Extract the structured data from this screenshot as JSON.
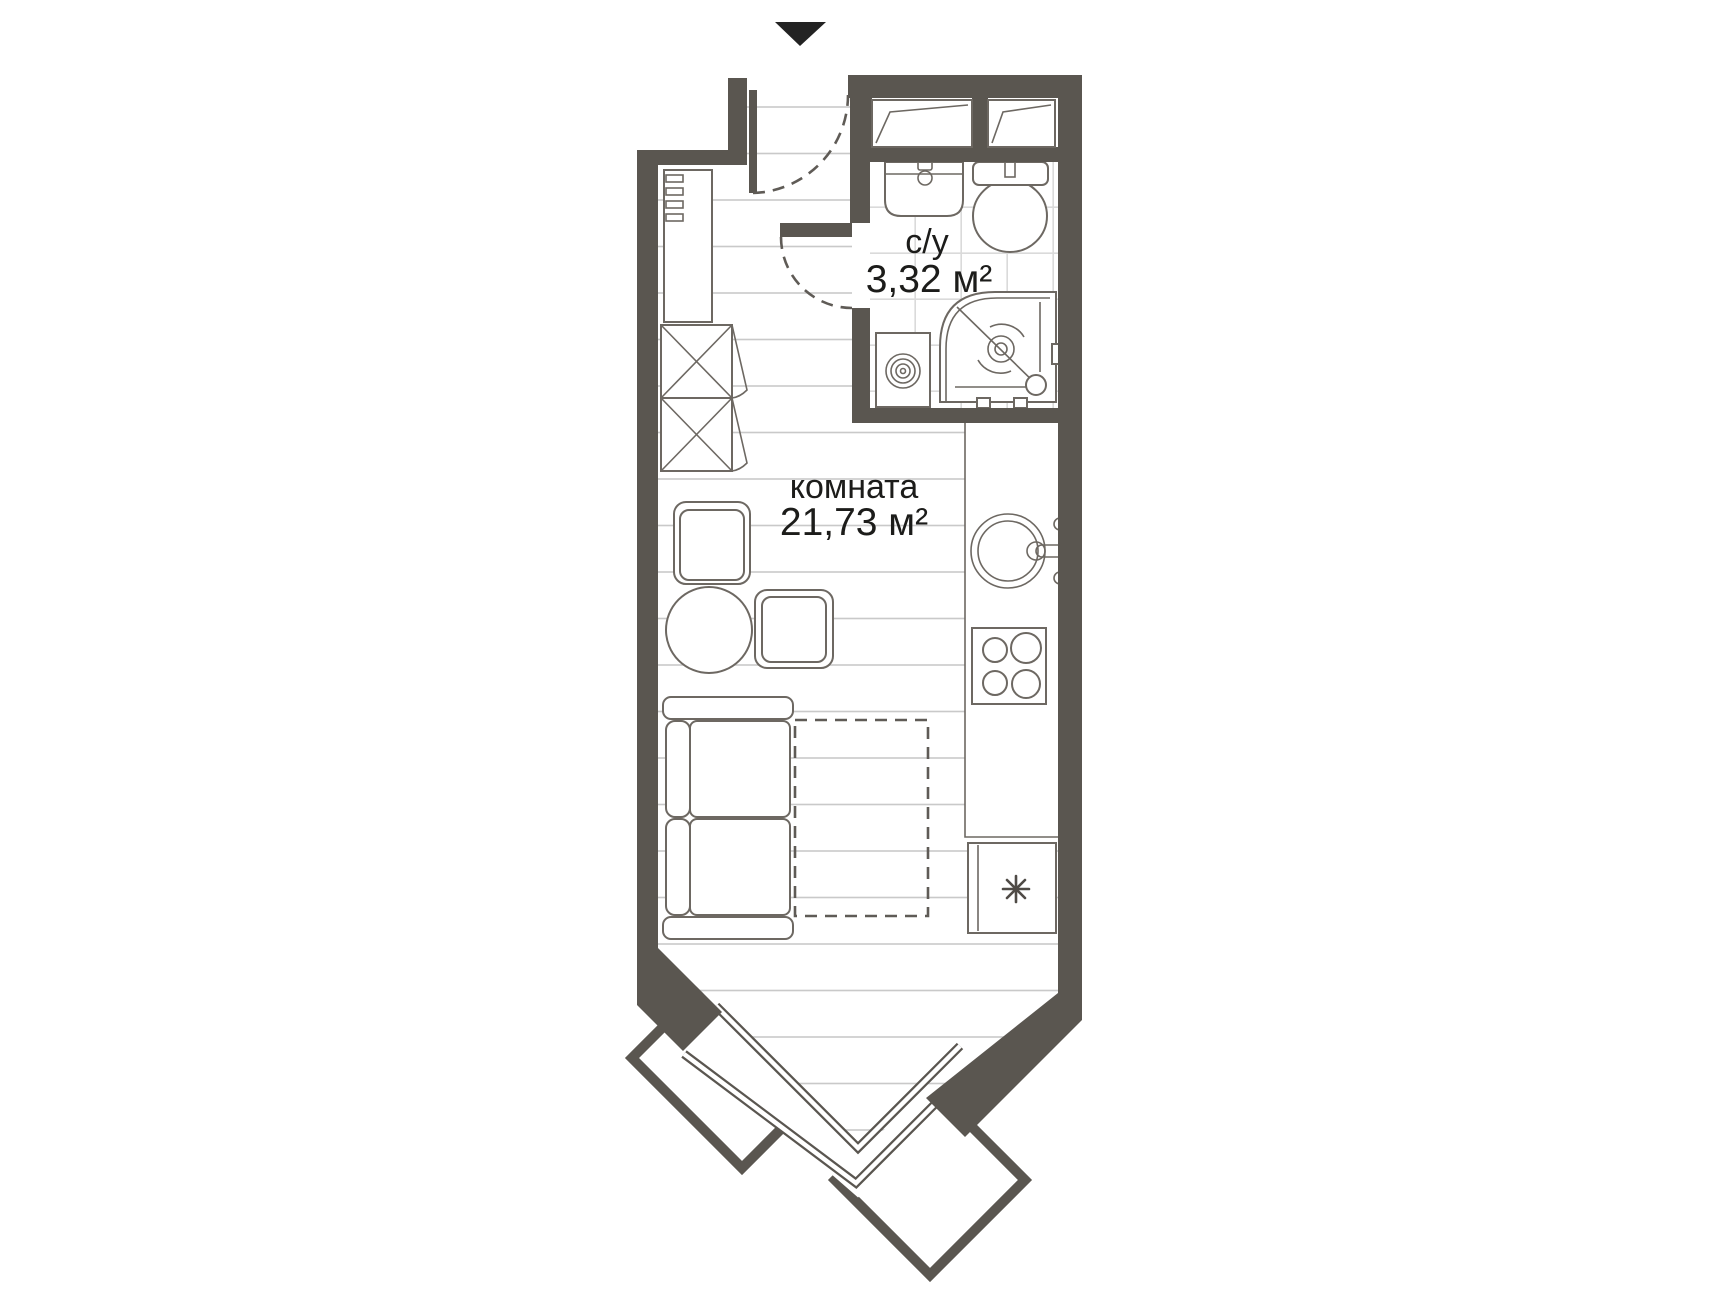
{
  "plan": {
    "title": "studio-apartment-floor-plan",
    "entrance_marker": "down-triangle",
    "rooms": [
      {
        "id": "bathroom",
        "name_label": "с/у",
        "area_label": "3,32 м²"
      },
      {
        "id": "room",
        "name_label": "комната",
        "area_label": "21,73 м²"
      }
    ],
    "fixtures": [
      "bathroom-sink",
      "toilet",
      "shower-cabin",
      "washing-machine",
      "vent-shaft",
      "vent-shaft",
      "hall-cabinet",
      "coat-hooks",
      "wardrobe-x",
      "wardrobe-x",
      "chair",
      "chair",
      "round-table",
      "sofa",
      "bed-dashed",
      "kitchen-counter",
      "kitchen-sink",
      "stove-4-burners",
      "fridge-freezer",
      "bay-window-v",
      "balcony-slab",
      "balcony-slab",
      "entrance-door-swing",
      "bathroom-door-swing"
    ],
    "fridge_symbol": "eight-spoke-asterisk"
  },
  "colors": {
    "wall": "#5a5650",
    "outline": "#6d6862",
    "floor_line": "#c9c9c9",
    "tile_line": "#dadada",
    "dash": "#5f5b56",
    "text": "#1c1c1a",
    "arrow": "#232323",
    "bg": "#ffffff"
  }
}
